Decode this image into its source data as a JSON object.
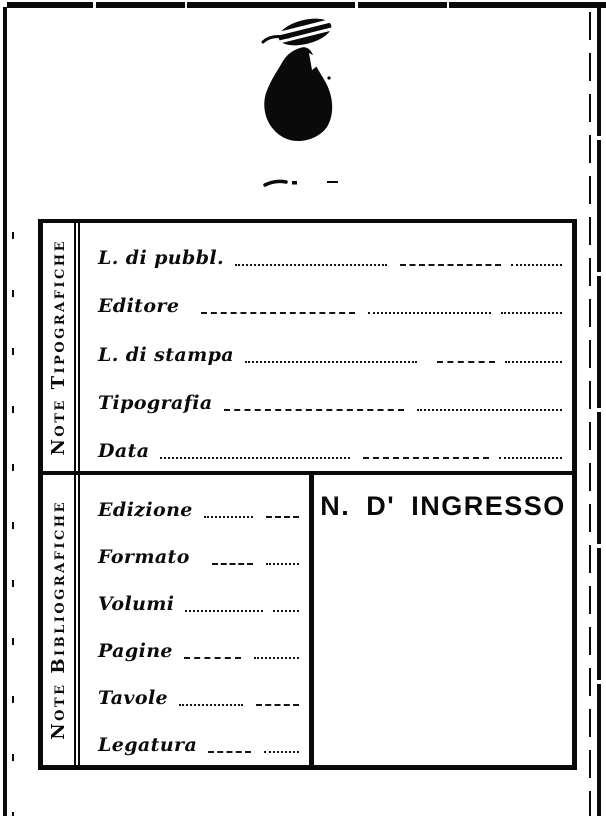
{
  "card": {
    "colors": {
      "ink": "#0a0a0a",
      "paper": "#ffffff"
    },
    "stamp_icon": "ink-blot-stamp",
    "sections": {
      "tipografiche": {
        "side_label": "Note Tipografiche",
        "fields": [
          "L. di pubbl.",
          "Editore",
          "L. di stampa",
          "Tipografia",
          "Data"
        ]
      },
      "bibliografiche": {
        "side_label": "Note Bibliografiche",
        "fields": [
          "Edizione",
          "Formato",
          "Volumi",
          "Pagine",
          "Tavole",
          "Legatura"
        ],
        "ingresso_label": "N. D' INGRESSO"
      }
    }
  }
}
